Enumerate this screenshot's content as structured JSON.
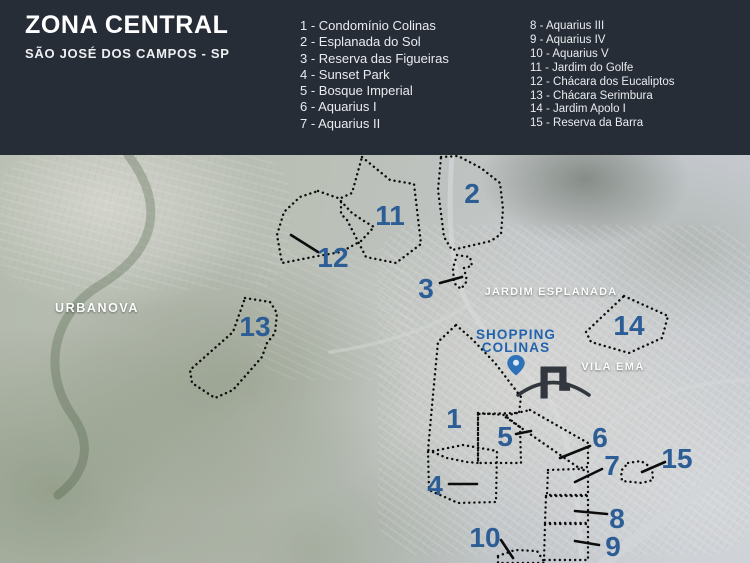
{
  "header": {
    "title": "ZONA CENTRAL",
    "subtitle": "SÃO JOSÉ DOS CAMPOS - SP",
    "legend_col1": [
      "1 - Condomínio Colinas",
      "2 - Esplanada do Sol",
      "3 - Reserva das Figueiras",
      "4 - Sunset Park",
      "5 - Bosque Imperial",
      "6 - Aquarius I",
      "7 - Aquarius II"
    ],
    "legend_col2": [
      "8 - Aquarius III",
      "9 - Aquarius IV",
      "10 - Aquarius V",
      "11 - Jardim do Golfe",
      "12 - Chácara dos Eucaliptos",
      "13 - Chácara Serimbura",
      "14 - Jardim Apolo I",
      "15 - Reserva da Barra"
    ]
  },
  "map": {
    "colors": {
      "number_blue": "#2c5d95",
      "shopping_blue": "#2163ac",
      "pin_blue": "#2e72b8",
      "outline_black": "#0c0c0c",
      "header_bg": "#272d37"
    },
    "area_labels": [
      {
        "text": "URBANOVA",
        "x": 97,
        "y": 308,
        "size": 12.5,
        "spacing": 1.6
      },
      {
        "text": "JARDIM ESPLANADA",
        "x": 551,
        "y": 291,
        "size": 11,
        "spacing": 1.2
      },
      {
        "text": "VILA EMA",
        "x": 613,
        "y": 366,
        "size": 11,
        "spacing": 1.4
      }
    ],
    "shopping": {
      "line1": "SHOPPING",
      "line2": "COLINAS",
      "x": 516,
      "y1": 339,
      "y2": 352
    },
    "numbers": [
      {
        "n": "1",
        "x": 454,
        "y": 418
      },
      {
        "n": "2",
        "x": 472,
        "y": 193
      },
      {
        "n": "3",
        "x": 426,
        "y": 288
      },
      {
        "n": "4",
        "x": 435,
        "y": 485
      },
      {
        "n": "5",
        "x": 505,
        "y": 436
      },
      {
        "n": "6",
        "x": 600,
        "y": 437
      },
      {
        "n": "7",
        "x": 612,
        "y": 465
      },
      {
        "n": "8",
        "x": 617,
        "y": 518
      },
      {
        "n": "9",
        "x": 613,
        "y": 546
      },
      {
        "n": "10",
        "x": 485,
        "y": 537
      },
      {
        "n": "11",
        "x": 390,
        "y": 215
      },
      {
        "n": "12",
        "x": 333,
        "y": 257
      },
      {
        "n": "13",
        "x": 255,
        "y": 326
      },
      {
        "n": "14",
        "x": 629,
        "y": 325
      },
      {
        "n": "15",
        "x": 677,
        "y": 458
      }
    ],
    "regions": [
      {
        "n": "1",
        "points": "456,325 472,339 495,363 508,380 521,397 519,413 478,414 478,463 467,462 447,458 428,450 433,395 438,342"
      },
      {
        "n": "2",
        "points": "441,157 458,156 481,168 500,183 503,209 501,234 491,241 452,250 444,237 438,190"
      },
      {
        "n": "3",
        "points": "457,255 470,257 472,266 464,268 467,281 461,289 454,283 453,268"
      },
      {
        "n": "4",
        "points": "428,452 463,445 497,451 496,502 458,503 429,490"
      },
      {
        "n": "5",
        "points": "478,413 504,415 520,427 521,463 478,463"
      },
      {
        "n": "6",
        "points": "530,410 588,443 588,467 579,468 504,416"
      },
      {
        "n": "7",
        "points": "548,470 579,469 588,471 588,495 547,495"
      },
      {
        "n": "8",
        "points": "546,496 588,496 588,523 545,523"
      },
      {
        "n": "9",
        "points": "545,524 588,524 588,560 544,560"
      },
      {
        "n": "10",
        "points": "498,556 515,550 537,551 545,563 498,563"
      },
      {
        "n": "11",
        "points": "362,157 390,180 414,184 421,244 396,263 366,257 347,220 341,214 341,198 352,193"
      },
      {
        "n": "12",
        "points": "318,191 338,198 352,213 364,221 374,227 361,241 341,252 318,256 282,263 277,235 284,212 300,197"
      },
      {
        "n": "13",
        "points": "245,298 270,302 277,313 275,333 267,343 262,357 233,390 215,398 192,383 190,370 233,332"
      },
      {
        "n": "14",
        "points": "624,296 668,316 662,338 629,353 591,342 586,332"
      },
      {
        "n": "15",
        "points": "628,463 641,461 652,468 653,480 642,483 622,481 621,471"
      }
    ],
    "pointer_lines": [
      {
        "n": "3",
        "x1": 440,
        "y1": 283,
        "x2": 462,
        "y2": 277
      },
      {
        "n": "4",
        "x1": 449,
        "y1": 484,
        "x2": 477,
        "y2": 484
      },
      {
        "n": "5",
        "x1": 516,
        "y1": 434,
        "x2": 531,
        "y2": 431
      },
      {
        "n": "6",
        "x1": 560,
        "y1": 458,
        "x2": 590,
        "y2": 446
      },
      {
        "n": "7",
        "x1": 575,
        "y1": 482,
        "x2": 602,
        "y2": 469
      },
      {
        "n": "8",
        "x1": 575,
        "y1": 511,
        "x2": 607,
        "y2": 514
      },
      {
        "n": "9",
        "x1": 575,
        "y1": 541,
        "x2": 599,
        "y2": 545
      },
      {
        "n": "10",
        "x1": 501,
        "y1": 540,
        "x2": 513,
        "y2": 558
      },
      {
        "n": "12",
        "x1": 291,
        "y1": 235,
        "x2": 318,
        "y2": 252
      },
      {
        "n": "15",
        "x1": 642,
        "y1": 472,
        "x2": 665,
        "y2": 462
      }
    ]
  }
}
